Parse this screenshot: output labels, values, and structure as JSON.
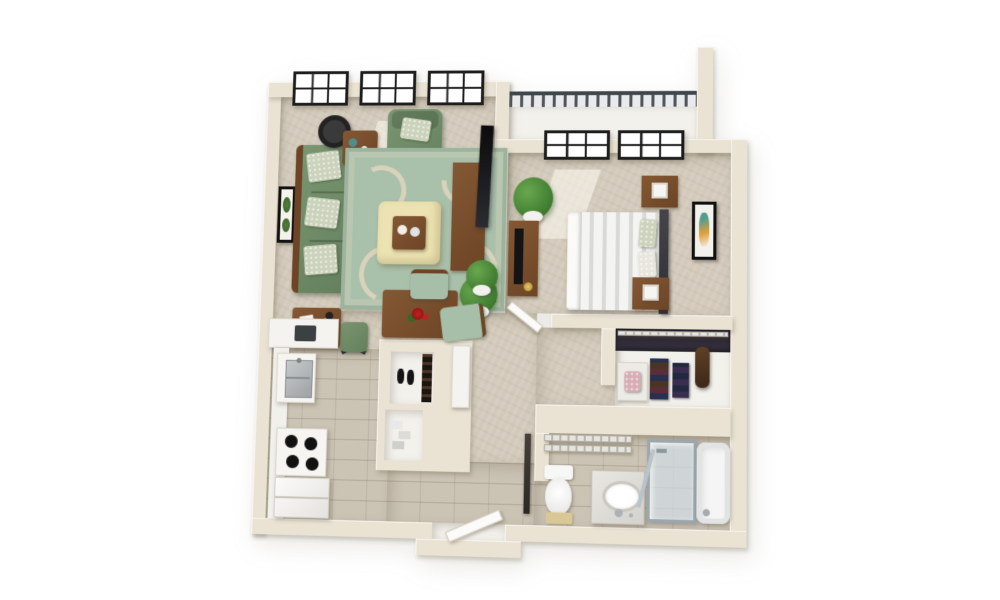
{
  "scene": {
    "type": "3d-floorplan-render",
    "description": "3D top-down rendering of a one-bedroom, one-bathroom apartment floor plan with balcony",
    "background": "#ffffff",
    "visible_text": ""
  },
  "palette": {
    "wall": "#eae3d4",
    "carpet": "#d3cabb",
    "tile": "#cbc3b4",
    "white_floor": "#f3f1ec",
    "sofa_green": "#74906b",
    "rug_green": "#a9c0ab",
    "rug_cream": "#dbd4bb",
    "ottoman_cream": "#ece2b2",
    "wood_brown": "#7a5130",
    "window_frame": "#1d1d1d",
    "railing_gray": "#4e555b",
    "bedding_white": "#f1f1ef",
    "headboard_dark": "#3c3c40",
    "plant_green": "#4c8a3c",
    "appliance_white": "#f6f5f2"
  },
  "rooms": {
    "living_room": {
      "label": "Living room",
      "floor": "carpet",
      "windows": 3,
      "items": [
        "sofa with three patterned pillows",
        "accent chair with pillow",
        "area rug with scroll pattern",
        "ottoman coffee table with serving tray",
        "arc lamp",
        "side table",
        "desk with papers",
        "desk chair",
        "tv console",
        "flat-screen tv",
        "floor plant",
        "framed botanical wall art"
      ]
    },
    "balcony": {
      "label": "Balcony",
      "floor": "white deck",
      "items": [
        "metal railing",
        "tall corner privacy wall"
      ]
    },
    "bedroom": {
      "label": "Bedroom",
      "floor": "carpet",
      "windows": 2,
      "items": [
        "bed with striped duvet and dark headboard",
        "nightstand with cube lamp (top)",
        "nightstand with cube lamp (bottom)",
        "dresser with tv and lamp",
        "corner plant",
        "framed wall art"
      ]
    },
    "dining_nook": {
      "label": "Dining nook",
      "floor": "carpet",
      "items": [
        "dining table with red flowers",
        "dining chair (top)",
        "dining chair (side)",
        "potted plant"
      ]
    },
    "kitchen": {
      "label": "Kitchen",
      "floor": "tile",
      "items": [
        "upper counter with microwave",
        "counter run",
        "stainless sink",
        "four-burner stove",
        "refrigerator",
        "side cabinet"
      ]
    },
    "closets": {
      "label": "Closets",
      "items": [
        "shoe closet with shoe rack and shoes",
        "linen closet with supplies",
        "walk-in closet with wire shelf, folded clothes, garment bag and bench"
      ]
    },
    "hallway": {
      "label": "Hallway",
      "floor": "carpet and tile",
      "items": [
        "bedroom door",
        "bathroom door",
        "entry door"
      ]
    },
    "bathroom": {
      "label": "Bathroom",
      "floor": "tile",
      "items": [
        "toilet",
        "bath mat",
        "vanity with oval sink",
        "glass shower enclosure",
        "bathtub",
        "wire shelves"
      ]
    }
  }
}
